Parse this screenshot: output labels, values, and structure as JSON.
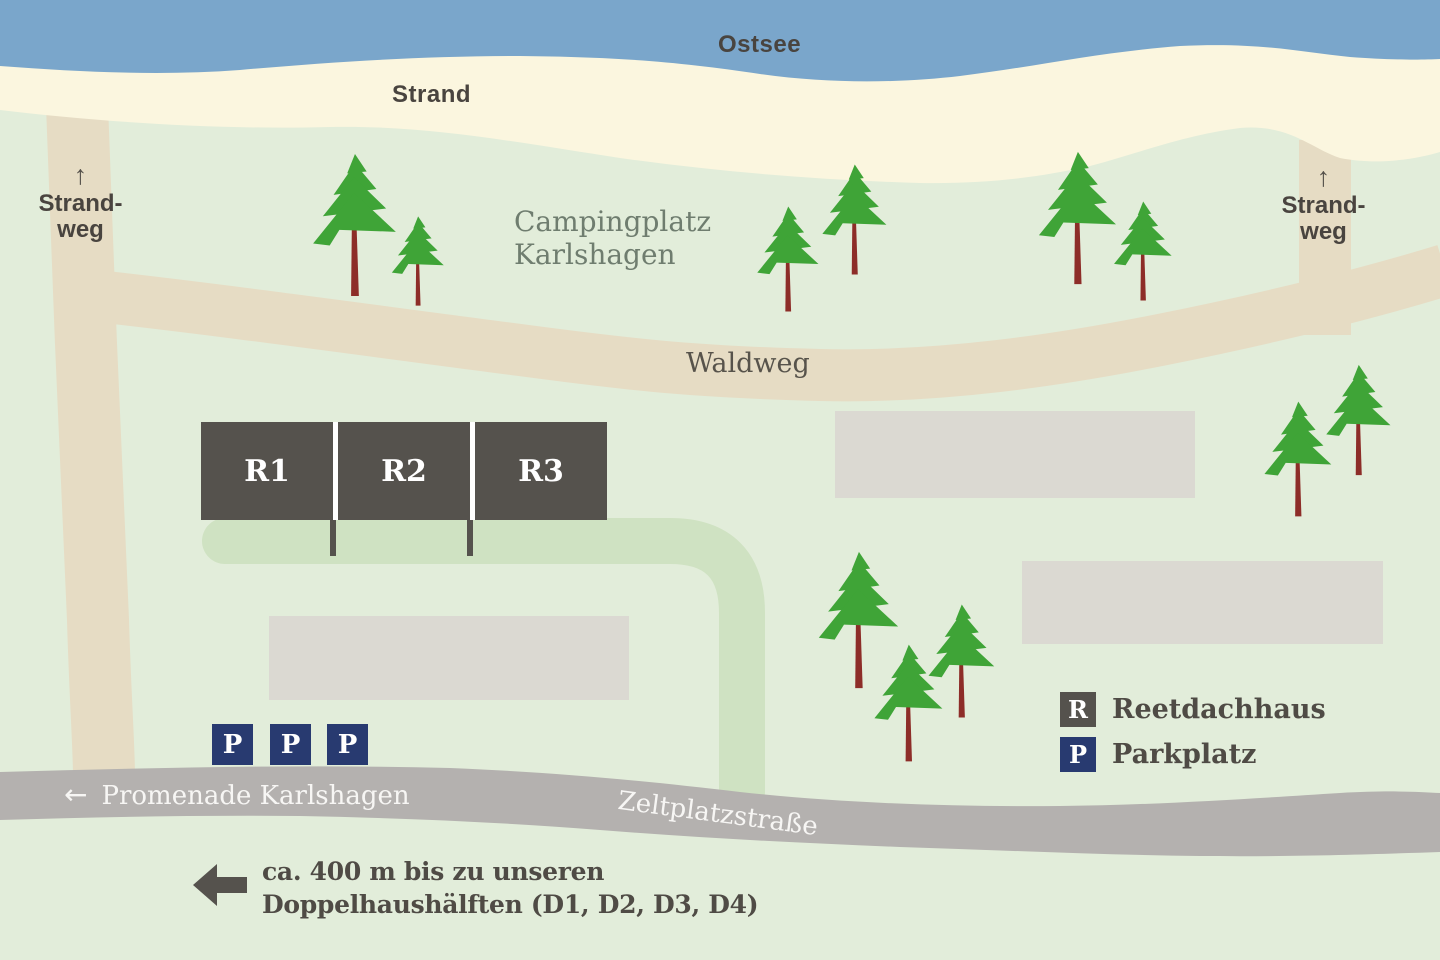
{
  "labels": {
    "sea": "Ostsee",
    "beach": "Strand",
    "campsite": {
      "line1": "Campingplatz",
      "line2": "Karlshagen"
    },
    "forest_path": "Waldweg",
    "beach_path": {
      "line1": "Strand-",
      "line2": "weg"
    }
  },
  "icons": {
    "up_arrow": "↑",
    "left_arrow": "←"
  },
  "buildings": {
    "reetdachhaeuser": [
      "R1",
      "R2",
      "R3"
    ]
  },
  "parking_spots": [
    "P",
    "P",
    "P"
  ],
  "legend": {
    "items": [
      {
        "symbol": "R",
        "label": "Reetdachhaus"
      },
      {
        "symbol": "P",
        "label": "Parkplatz"
      }
    ]
  },
  "roads": {
    "promenade": "Promenade Karlshagen",
    "zeltplatz": "Zeltplatzstraße"
  },
  "footer": {
    "line1": "ca. 400 m bis zu unseren",
    "line2": "Doppelhaushälften (D1, D2, D3, D4)"
  },
  "colors": {
    "water": "#7aa6cb",
    "sand": "#fbf6df",
    "ground": "#e2edda",
    "path_tan": "#e6dcc4",
    "loop_path_green": "#cfe2c2",
    "road_gray": "#b4b1af",
    "building_dark": "#55524d",
    "building_light": "#dbd9d2",
    "parking_blue": "#283a70",
    "tree_green": "#3fa437",
    "trunk_red": "#8d2d28",
    "text_dark": "#4f4b45",
    "text_green": "#6f7d6f",
    "text_light": "#ffffff"
  }
}
